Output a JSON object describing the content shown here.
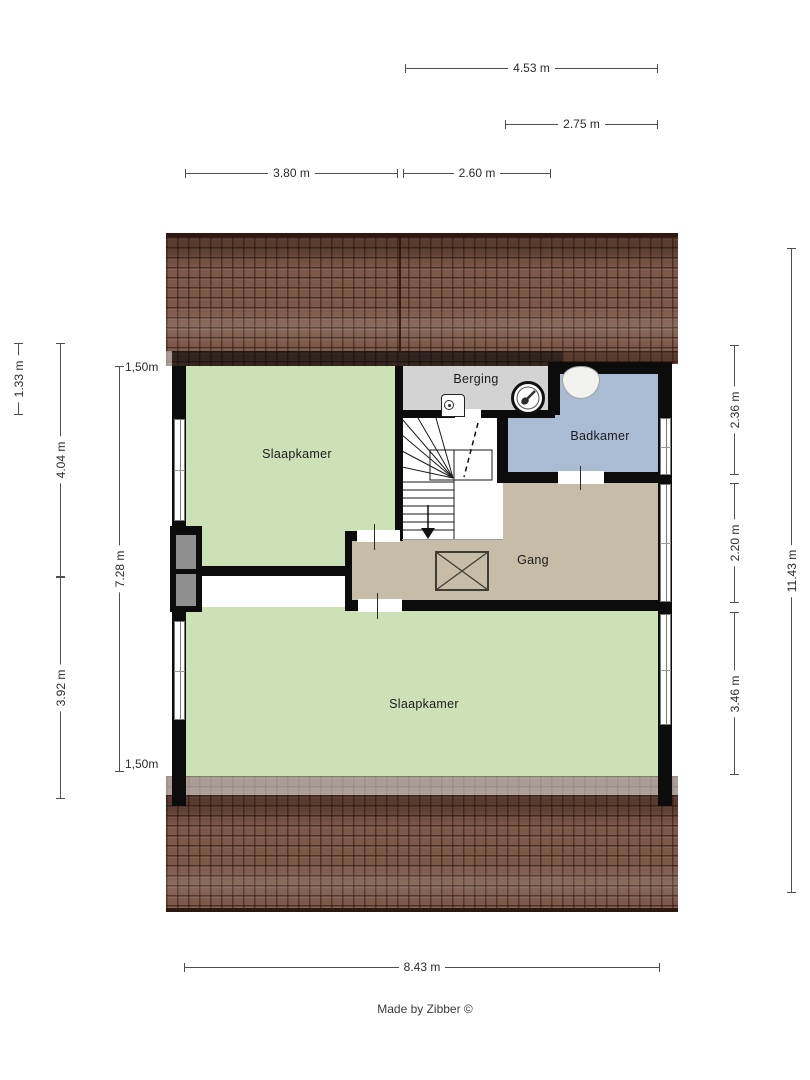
{
  "rooms": {
    "slaapkamer_top": {
      "label": "Slaapkamer"
    },
    "slaapkamer_bottom": {
      "label": "Slaapkamer"
    },
    "berging": {
      "label": "Berging"
    },
    "badkamer": {
      "label": "Badkamer"
    },
    "gang": {
      "label": "Gang"
    }
  },
  "dimensions": {
    "top": [
      "4.53 m",
      "2.75 m",
      "3.80 m",
      "2.60 m"
    ],
    "left": [
      "1.33 m",
      "4.04 m",
      "3.92 m",
      "7.28 m"
    ],
    "right": [
      "2.36 m",
      "2.20 m",
      "3.46 m",
      "11.43 m"
    ],
    "bottom": [
      "8.43 m"
    ],
    "height_markers": [
      "1,50m",
      "1,50m"
    ]
  },
  "credit": "Made by Zibber ©",
  "colors": {
    "wall": "#0c0c0c",
    "room_green": "#cde1b6",
    "room_grey": "#d3d3d3",
    "room_blue": "#a9bcd3",
    "room_tan": "#c7bca7",
    "roof_brown": "#7c5849",
    "dim_line": "#4f4f4f"
  }
}
